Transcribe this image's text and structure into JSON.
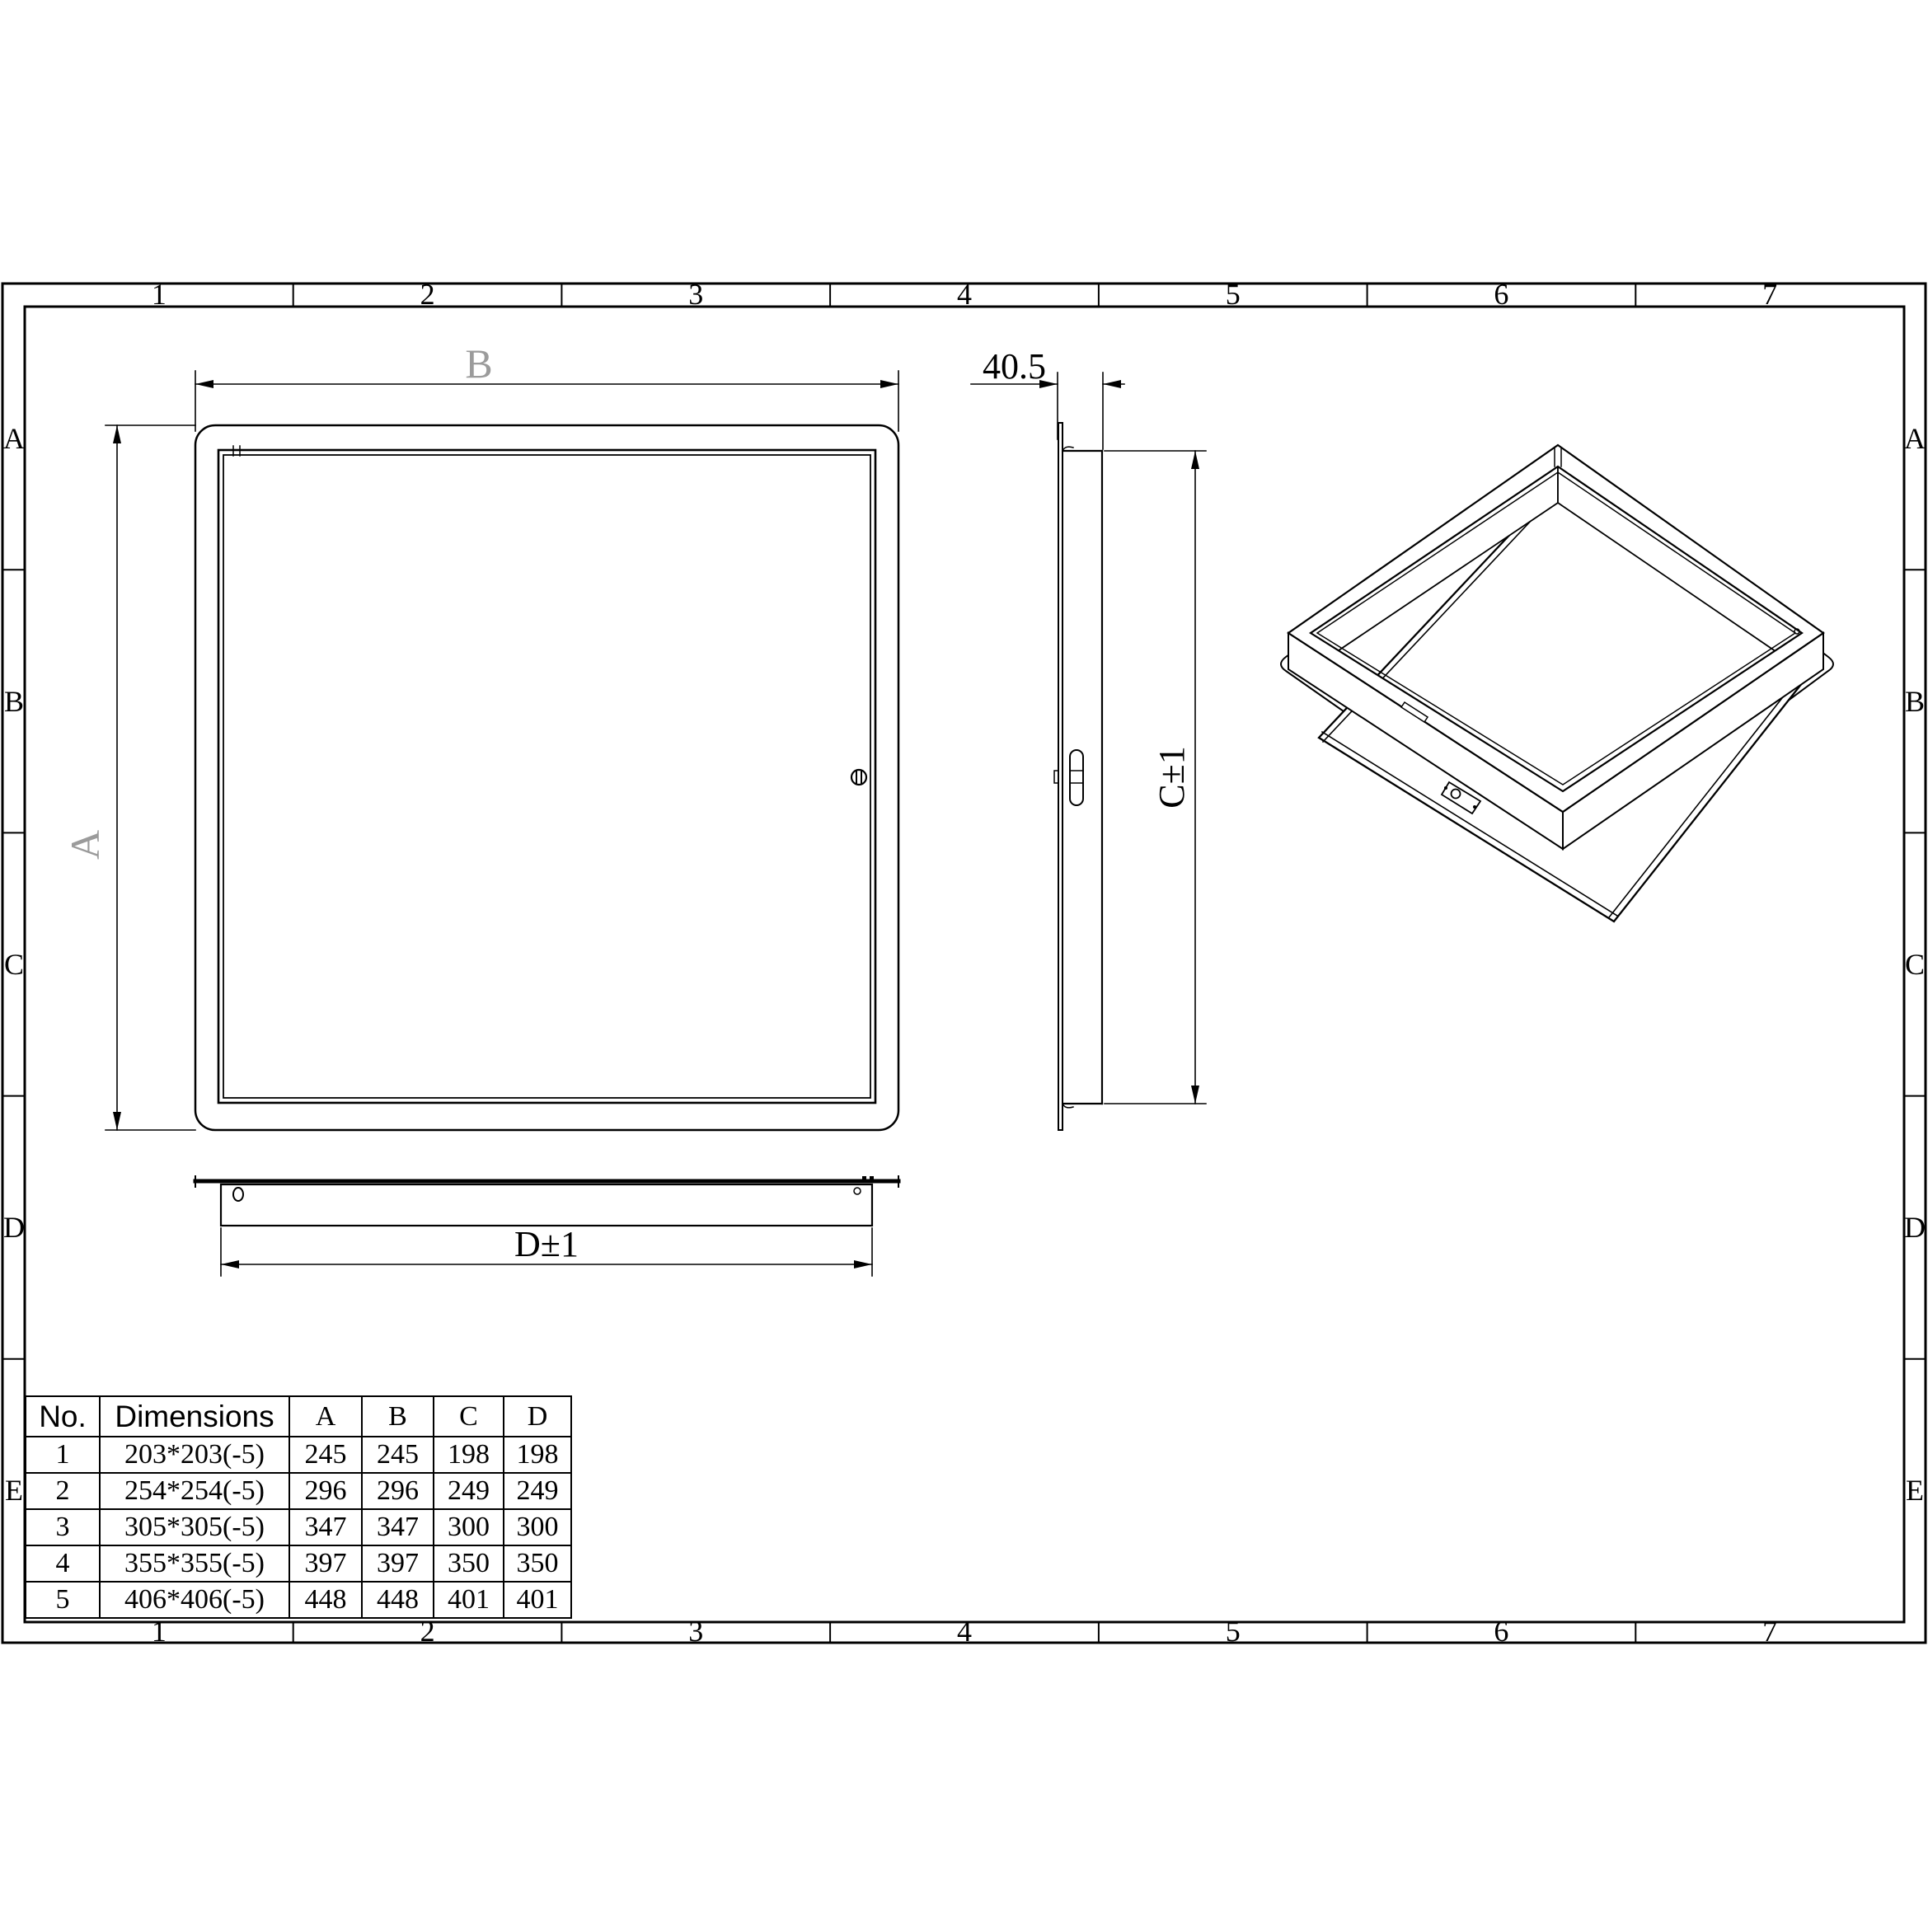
{
  "page": {
    "background": "#ffffff",
    "line_color": "#000000",
    "ghost_label_color": "#9b9b9b"
  },
  "grid": {
    "columns": [
      "1",
      "2",
      "3",
      "4",
      "5",
      "6",
      "7"
    ],
    "rows": [
      "A",
      "B",
      "C",
      "D",
      "E"
    ]
  },
  "front_view": {
    "width_label": "B",
    "height_label": "A"
  },
  "side_view": {
    "depth_label": "40.5",
    "height_label": "C±1"
  },
  "bottom_view": {
    "width_label": "D±1"
  },
  "spec_table": {
    "headers": [
      "No.",
      "Dimensions",
      "A",
      "B",
      "C",
      "D"
    ],
    "rows": [
      [
        "1",
        "203*203(-5)",
        "245",
        "245",
        "198",
        "198"
      ],
      [
        "2",
        "254*254(-5)",
        "296",
        "296",
        "249",
        "249"
      ],
      [
        "3",
        "305*305(-5)",
        "347",
        "347",
        "300",
        "300"
      ],
      [
        "4",
        "355*355(-5)",
        "397",
        "397",
        "350",
        "350"
      ],
      [
        "5",
        "406*406(-5)",
        "448",
        "448",
        "401",
        "401"
      ]
    ]
  }
}
